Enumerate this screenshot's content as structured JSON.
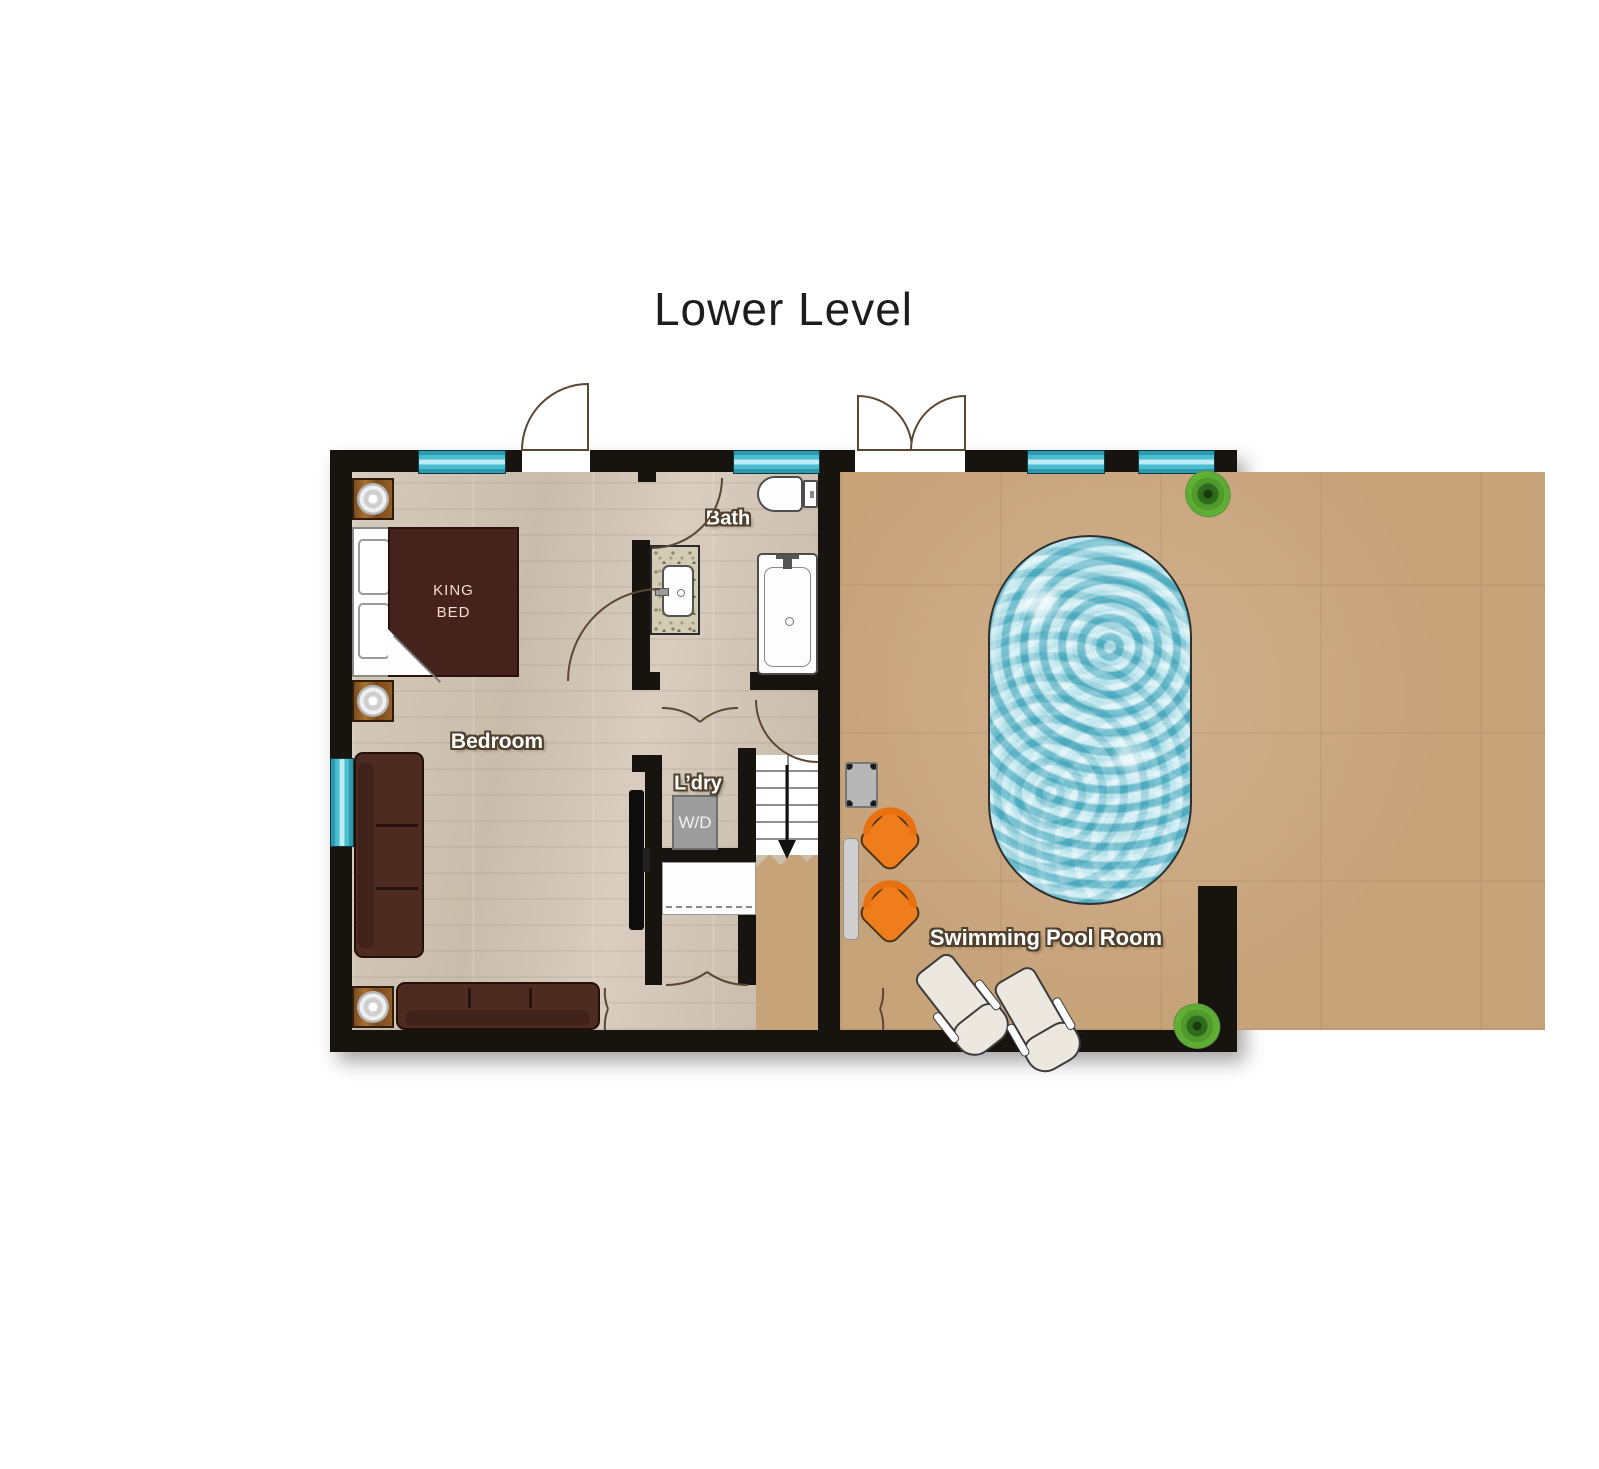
{
  "title": "Lower Level",
  "labels": {
    "bedroom": "Bedroom",
    "bath": "Bath",
    "laundry": "L’dry",
    "washer_dryer": "W/D",
    "pool_room": "Swimming Pool Room",
    "king_bed_line1": "KING",
    "king_bed_line2": "BED"
  },
  "colors": {
    "wall": "#17140f",
    "wood_floor": "#cfc3b4",
    "pool_room_floor": "#c7a37a",
    "window_teal": "#49bcd0",
    "pool_water": "#7ecfdd",
    "bed_and_sofa": "#4a2a20",
    "accent_chair_orange": "#ef7d1c",
    "plant_green": "#5aa82f",
    "door_arc": "#5c4733"
  }
}
